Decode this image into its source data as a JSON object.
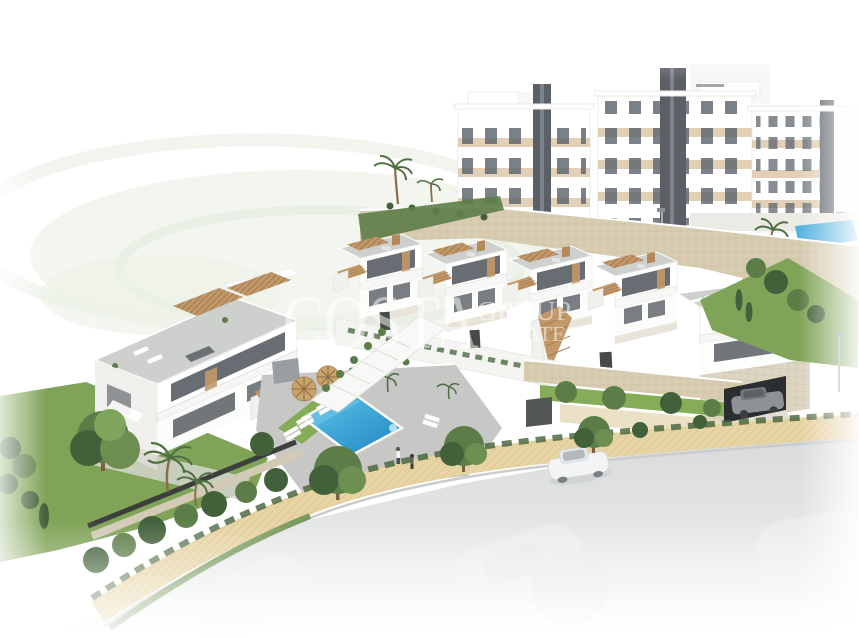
{
  "watermark": {
    "brand": "COSTA",
    "group_line": "GROUP",
    "estates_line": "ESTATES"
  },
  "palette": {
    "background": "#ffffff",
    "pool_blue_light": "#63c5e9",
    "pool_blue_dark": "#1d86c3",
    "lawn_green": "#7fa457",
    "lawn_bright": "#85ad58",
    "foliage_dark": "#42603a",
    "foliage_mid": "#5d7d48",
    "stone_wall": "#d8cdb2",
    "wood_tan": "#c2986a",
    "beige_panel": "#dac4a2",
    "window_glass": "#4d545a",
    "tower_dark": "#5a6066",
    "roof_gray": "#cdd0cd",
    "deck_gray": "#c7c7c5",
    "path_sand": "#e7d4a4",
    "road_gray": "#d9dbdd",
    "car_white": "#f3f4f5",
    "car_gray": "#8e9195",
    "umbrella_straw": "#c9a46d"
  }
}
